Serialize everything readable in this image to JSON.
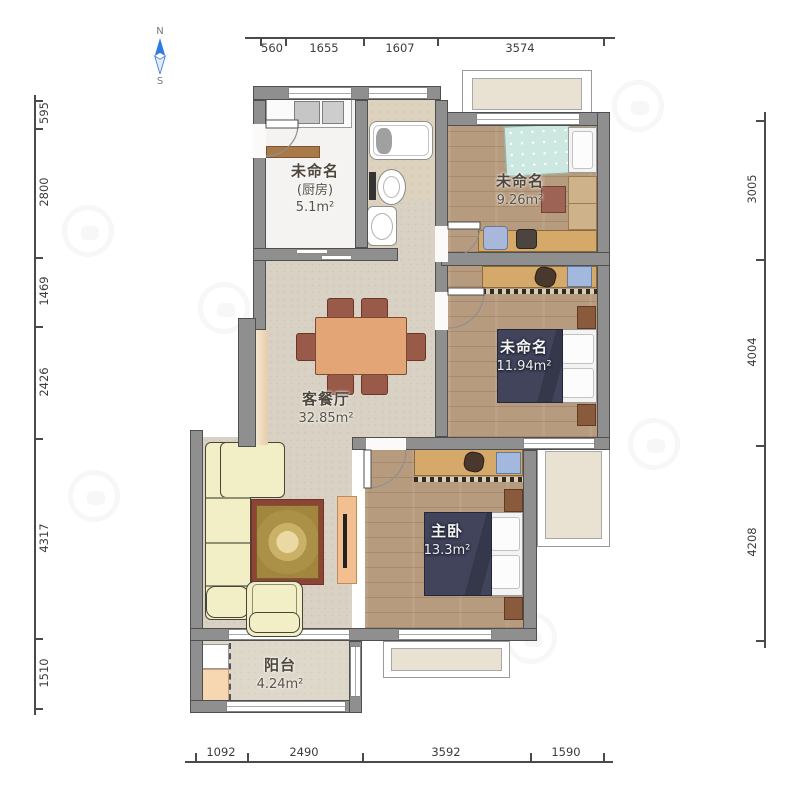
{
  "plan": {
    "rooms": {
      "kitchen": {
        "name": "未命名",
        "alias": "(厨房)",
        "area": "5.1m²"
      },
      "bedroom_top_right": {
        "name": "未命名",
        "area": "9.26m²"
      },
      "bedroom_middle_right": {
        "name": "未命名",
        "area": "11.94m²"
      },
      "living_dining": {
        "name": "客餐厅",
        "area": "32.85m²"
      },
      "master_bedroom": {
        "name": "主卧",
        "area": "13.3m²"
      },
      "balcony": {
        "name": "阳台",
        "area": "4.24m²"
      }
    }
  },
  "compass": {
    "north_label": "N",
    "south_label": "S"
  },
  "dimensions_mm": {
    "top": [
      "560",
      "1655",
      "1607",
      "3574"
    ],
    "bottom": [
      "1092",
      "2490",
      "3592",
      "1590"
    ],
    "left": [
      "595",
      "2800",
      "1469",
      "2426",
      "4317",
      "1510"
    ],
    "right": [
      "3005",
      "4004",
      "4208"
    ]
  },
  "colors": {
    "wall_fill": "#8f8f8f",
    "wall_outline": "#4a4a4a",
    "wood_floor": "#b69b7e",
    "marble_floor": "#f4f3f1",
    "tile_floor": "#ddd2bd",
    "concrete_floor": "#d9d2c4",
    "navy_bed": "#41445b",
    "teal_bed": "#cde8e1",
    "sofa_cream": "#f2eec6",
    "table_orange": "#e3a476",
    "chair_brown": "#9a5a49",
    "compass_blue": "#2f7be3"
  }
}
